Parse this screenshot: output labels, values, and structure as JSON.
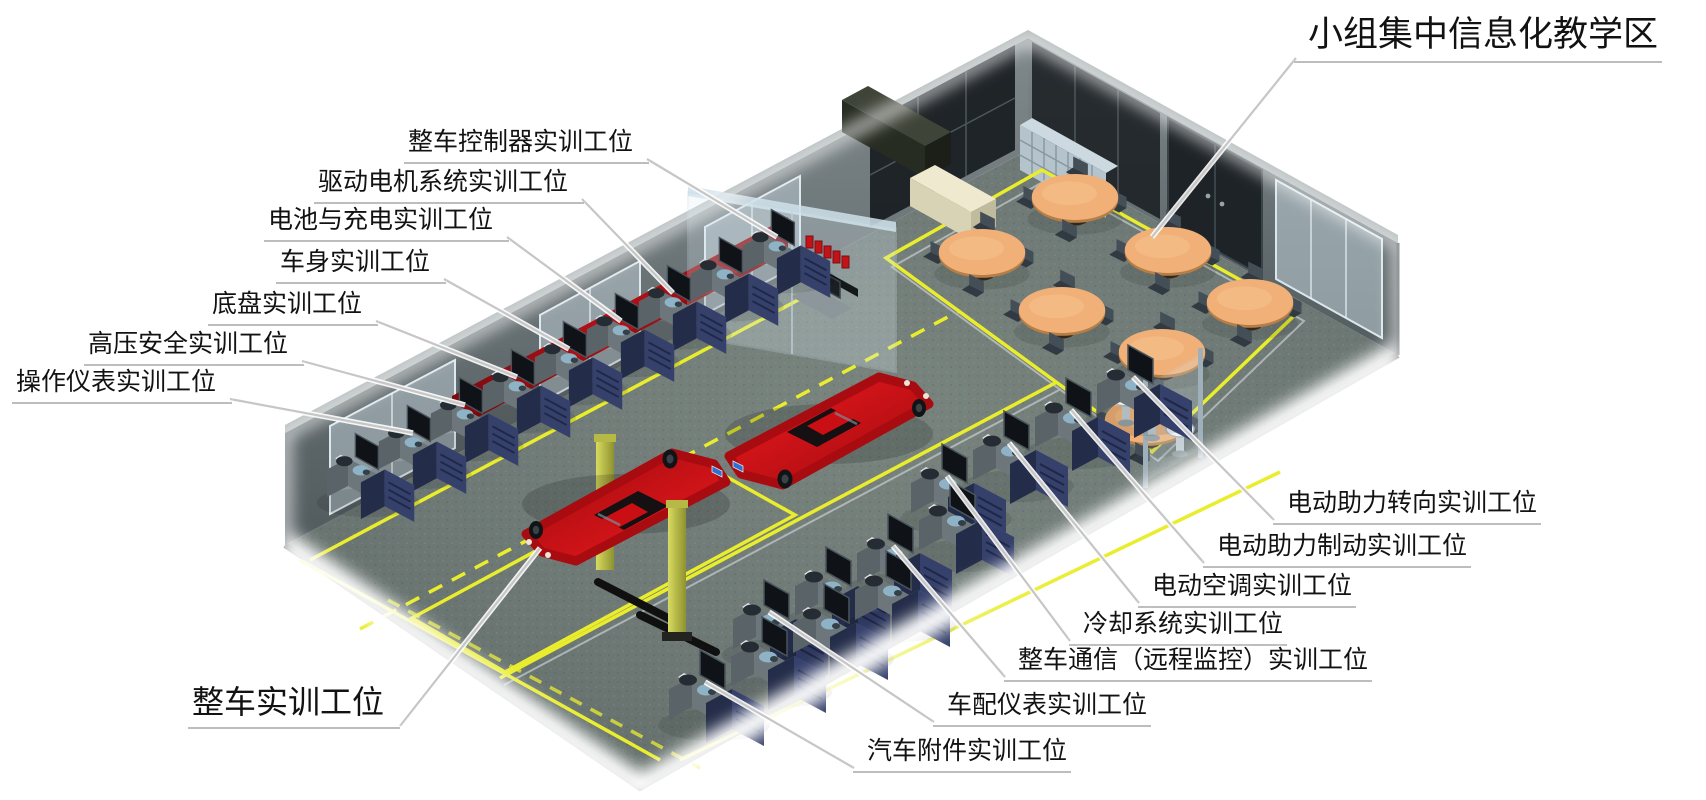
{
  "labels": {
    "teaching_area": "小组集中信息化教学区",
    "left_stations": [
      "整车控制器实训工位",
      "驱动电机系统实训工位",
      "电池与充电实训工位",
      "车身实训工位",
      "底盘实训工位",
      "高压安全实训工位",
      "操作仪表实训工位"
    ],
    "vehicle_station": "整车实训工位",
    "right_stations": [
      "电动助力转向实训工位",
      "电动助力制动实训工位",
      "电动空调实训工位",
      "冷却系统实训工位",
      "整车通信（远程监控）实训工位",
      "车配仪表实训工位",
      "汽车附件实训工位"
    ]
  },
  "colors": {
    "background": "#ffffff",
    "floor": "#6d7875",
    "wall": "#687174",
    "marking_yellow": "#e9ed2c",
    "leader_gray": "#c6c6c6",
    "banner_red": "#9d0f13",
    "car_red": "#cf1016",
    "table_wood": "#f0b077",
    "window_glass": "#c2d2da",
    "label_text": "#121212"
  }
}
